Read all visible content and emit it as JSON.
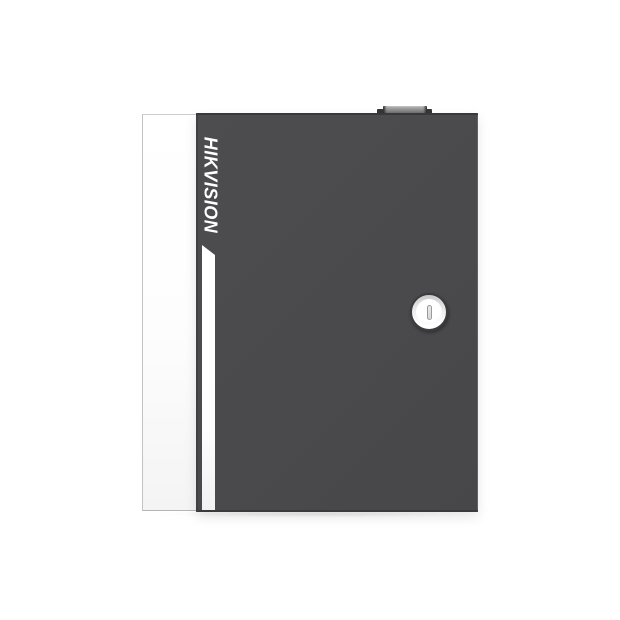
{
  "image": {
    "type": "product-photo",
    "background_color": "#ffffff",
    "device": {
      "name": "wall-mount controller enclosure, front view",
      "brand_label": "HIKVISION",
      "body_color": "#4a4a4c",
      "side_panel_color": "#ffffff",
      "accent_stripe_color": "#ffffff",
      "hinge_tab_color": "#8a8a8c",
      "lock": {
        "style": "keyhole",
        "face_color": "#f7f7f7",
        "ring_color": "#3c3c3e"
      }
    }
  }
}
